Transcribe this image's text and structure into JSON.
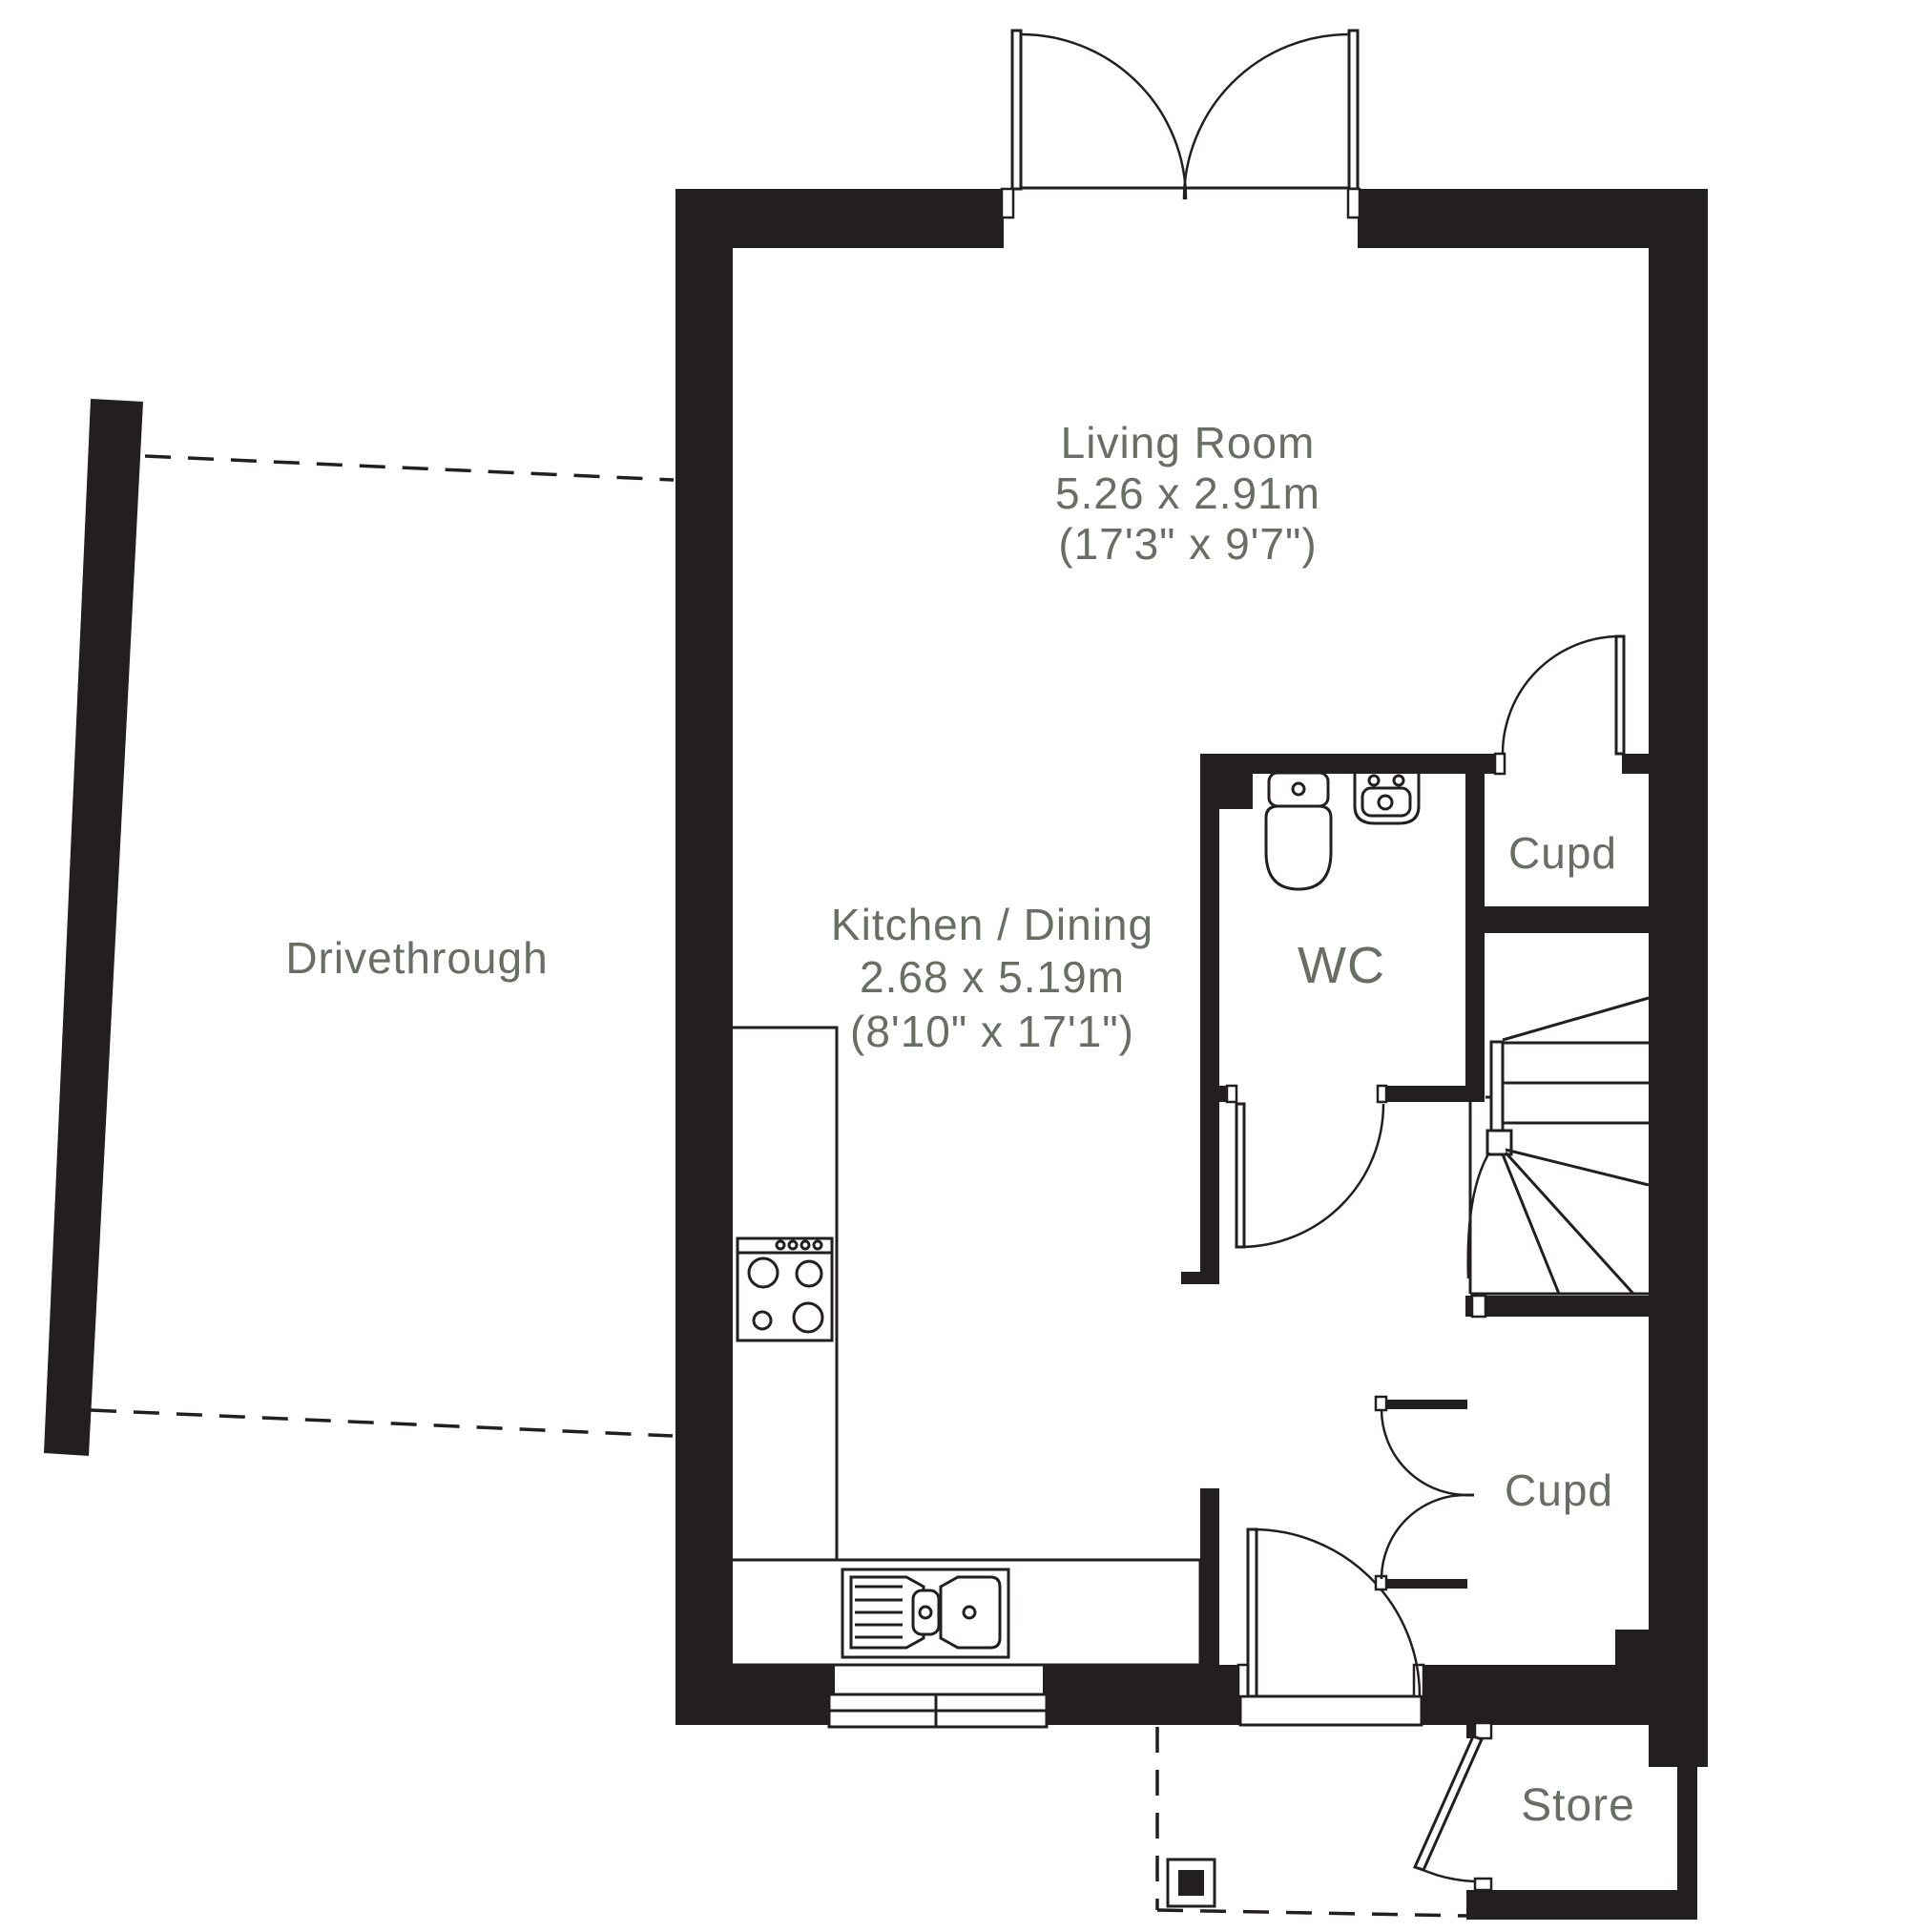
{
  "plan": {
    "colors": {
      "wall": "#231f20",
      "label": "#686e64",
      "background": "#ffffff"
    },
    "rooms": {
      "living_room": {
        "name": "Living Room",
        "metric": "5.26 x 2.91m",
        "imperial": "(17'3\" x 9'7\")"
      },
      "kitchen_dining": {
        "name": "Kitchen / Dining",
        "metric": "2.68 x 5.19m",
        "imperial": "(8'10\" x 17'1\")"
      },
      "wc": {
        "name": "WC"
      },
      "cupboard_upper": {
        "name": "Cupd"
      },
      "cupboard_lower": {
        "name": "Cupd"
      },
      "store": {
        "name": "Store"
      },
      "drivethrough": {
        "name": "Drivethrough"
      }
    }
  }
}
